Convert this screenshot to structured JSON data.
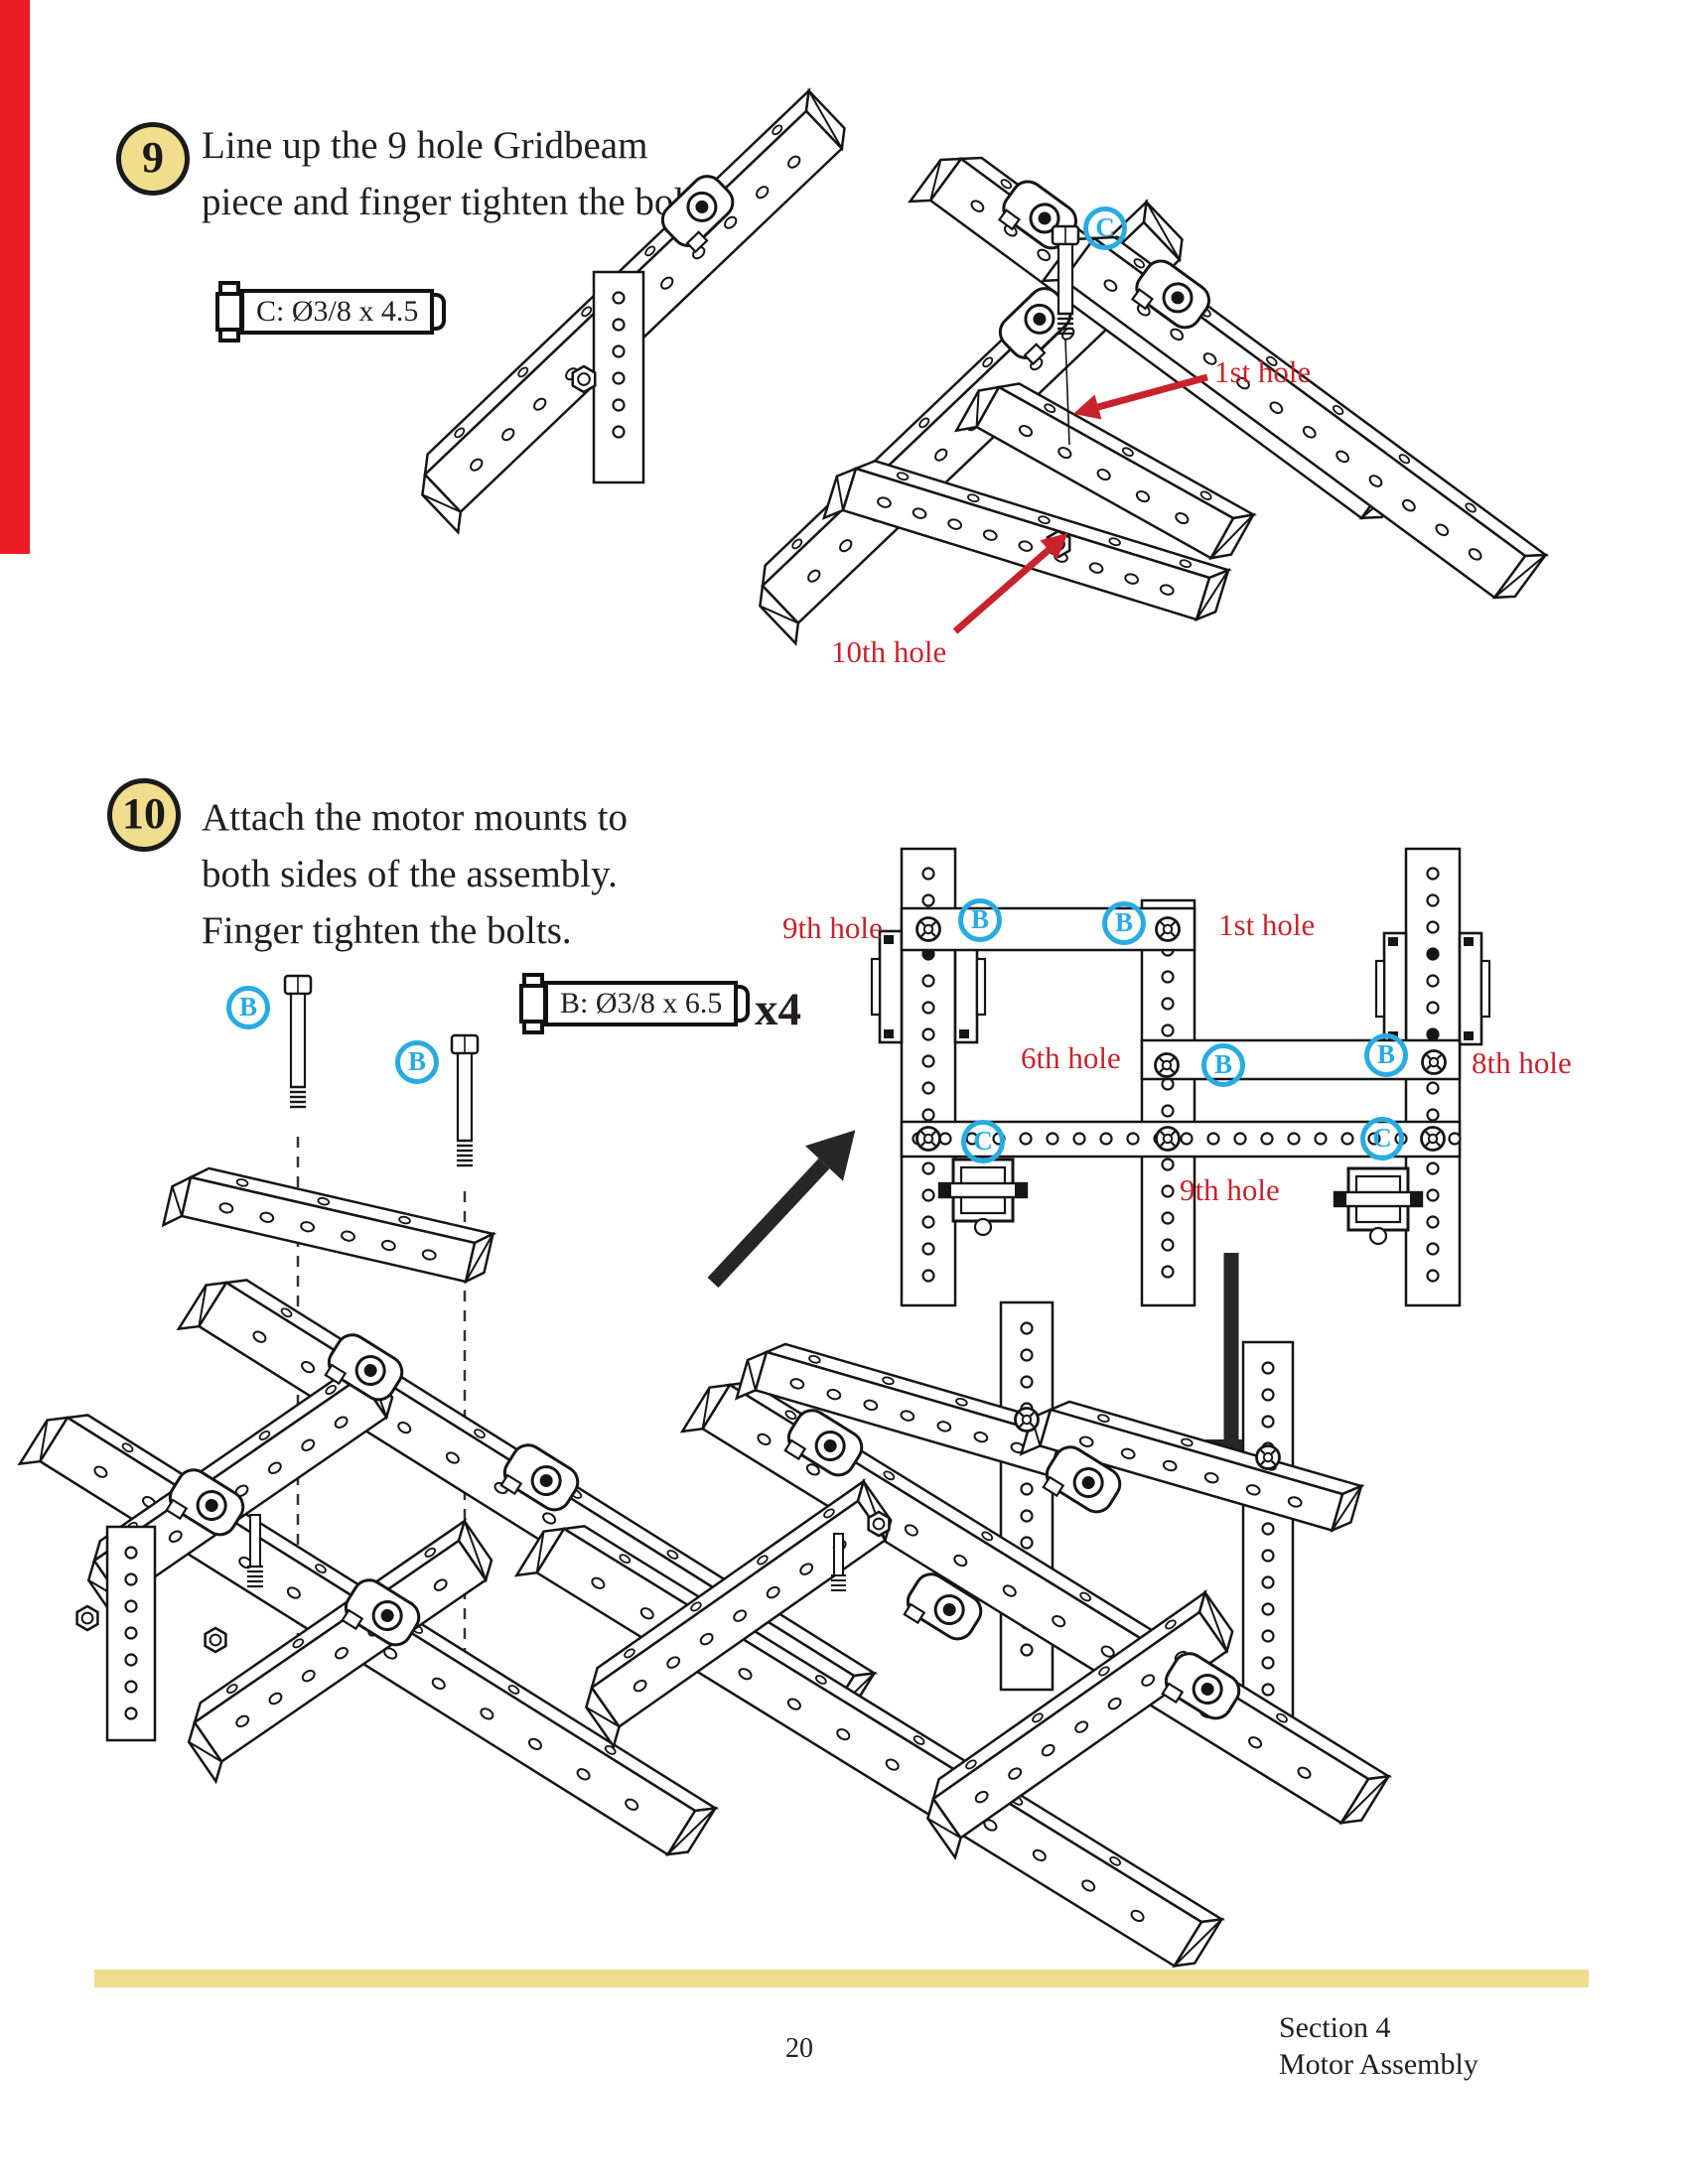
{
  "colors": {
    "accent_red": "#C8232C",
    "edge_bar_red": "#EC1C24",
    "callout_blue": "#29ABE2",
    "badge_yellow": "#F0DE8E",
    "footer_bar_yellow": "#EFDC8C",
    "ink": "#231F20"
  },
  "step9": {
    "number": "9",
    "instruction_line1": "Line up the 9 hole Gridbeam",
    "instruction_line2": "piece and finger tighten the bolt.",
    "bolt_label": "C: Ø3/8 x 4.5",
    "callout_c": "C",
    "label_first_hole": "1st hole",
    "label_tenth_hole": "10th hole"
  },
  "step10": {
    "number": "10",
    "instruction_line1": "Attach the motor mounts to",
    "instruction_line2": "both sides of the assembly.",
    "instruction_line3": "Finger tighten the bolts.",
    "bolt_label": "B: Ø3/8 x 6.5",
    "bolt_quantity": "x4",
    "callout_b": "B",
    "callout_c": "C",
    "label_ninth_hole_top": "9th hole",
    "label_first_hole": "1st hole",
    "label_sixth_hole": "6th hole",
    "label_eighth_hole": "8th hole",
    "label_ninth_hole_bottom": "9th hole"
  },
  "footer": {
    "page_number": "20",
    "section_line1": "Section 4",
    "section_line2": "Motor Assembly"
  }
}
